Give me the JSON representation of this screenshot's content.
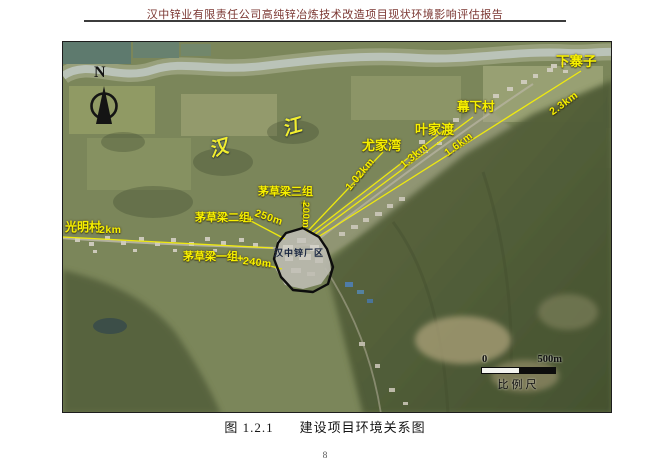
{
  "document": {
    "header_title": "汉中锌业有限责任公司高纯锌冶炼技术改造项目现状环境影响评估报告",
    "figure_caption": {
      "number": "图 1.2.1",
      "title": "建设项目环境关系图"
    },
    "page_number": "8"
  },
  "map": {
    "compass_label": "N",
    "river_label": "汉 江",
    "site": {
      "label": "汉中锌厂区"
    },
    "plus_marker": "+",
    "locations": [
      {
        "name": "光明村",
        "distance": "2km"
      },
      {
        "name": "茅草梁一组",
        "distance": "240m"
      },
      {
        "name": "茅草梁二组",
        "distance": "250m"
      },
      {
        "name": "茅草梁三组",
        "distance": "200m"
      },
      {
        "name": "尤家湾",
        "distance": "1.02km"
      },
      {
        "name": "叶家渡",
        "distance": "1.3km"
      },
      {
        "name": "幕下村",
        "distance": "1.6km"
      },
      {
        "name": "下寨子",
        "distance": "2.3km"
      }
    ],
    "scale_bar": {
      "start": "0",
      "end": "500m",
      "label": "比例尺"
    },
    "colors": {
      "annotation_yellow": "#f7f000",
      "river_label_yellow": "#f2ee2e",
      "site_outline_black": "#0d0d0d",
      "header_red": "#7a3530"
    }
  }
}
